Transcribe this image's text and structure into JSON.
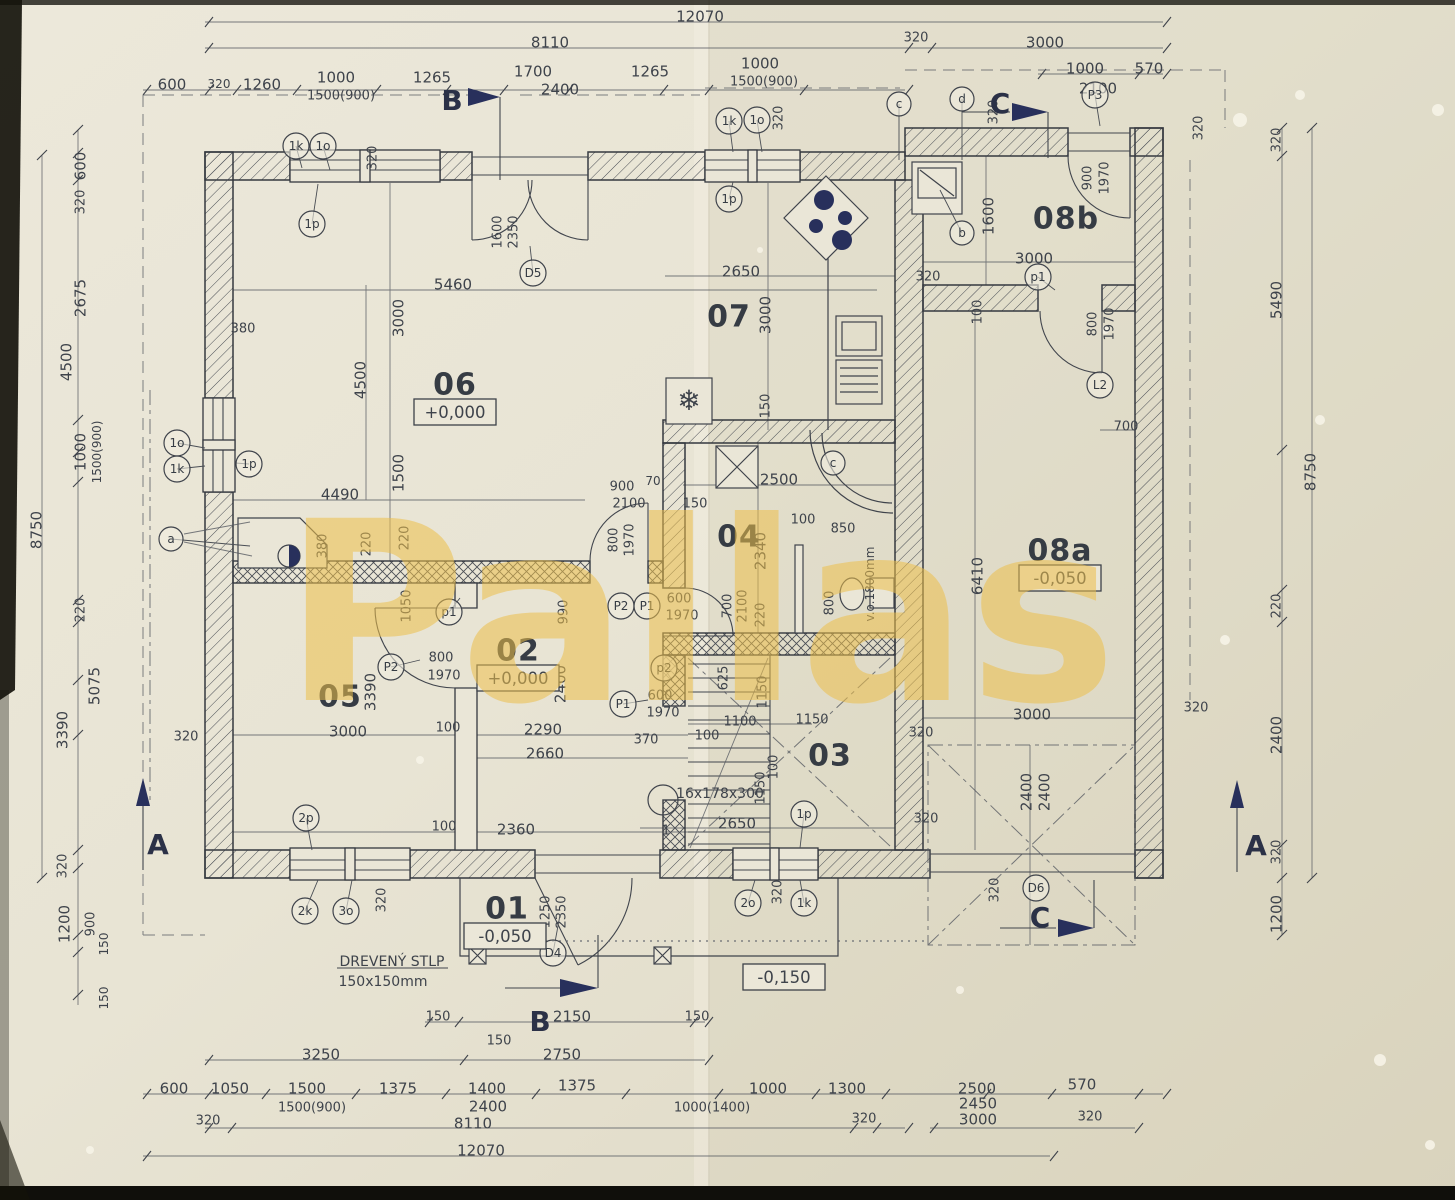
{
  "watermark": {
    "text": "Pallas",
    "color": "#edbf4b"
  },
  "colors": {
    "paper": "#e9e5d6",
    "ink": "#3c4149",
    "navy": "#28305c",
    "watermark": "#edbf4b"
  },
  "rooms": [
    {
      "num": "06",
      "x": 455,
      "y": 384,
      "elev": "+0,000",
      "ex": 455,
      "ey": 412
    },
    {
      "num": "07",
      "x": 729,
      "y": 316
    },
    {
      "num": "08b",
      "x": 1066,
      "y": 218
    },
    {
      "num": "08a",
      "x": 1060,
      "y": 550,
      "elev": "-0,050",
      "ex": 1060,
      "ey": 578
    },
    {
      "num": "04",
      "x": 739,
      "y": 536
    },
    {
      "num": "02",
      "x": 518,
      "y": 650,
      "elev": "+0,000",
      "ex": 518,
      "ey": 678
    },
    {
      "num": "05",
      "x": 340,
      "y": 696
    },
    {
      "num": "03",
      "x": 830,
      "y": 755
    },
    {
      "num": "01",
      "x": 507,
      "y": 908,
      "elev": "-0,050",
      "ex": 505,
      "ey": 936
    }
  ],
  "standalone_elevations": [
    {
      "t": "-0,150",
      "x": 784,
      "y": 977
    }
  ],
  "section_markers": [
    {
      "t": "B",
      "x": 452,
      "y": 100
    },
    {
      "t": "B",
      "x": 540,
      "y": 1021
    },
    {
      "t": "C",
      "x": 1000,
      "y": 103
    },
    {
      "t": "C",
      "x": 1040,
      "y": 917
    },
    {
      "t": "A",
      "x": 158,
      "y": 844
    },
    {
      "t": "A",
      "x": 1256,
      "y": 845
    }
  ],
  "notes": [
    {
      "t": "DREVENÝ STLP",
      "x": 392,
      "y": 961,
      "s": 14
    },
    {
      "t": "150x150mm",
      "x": 383,
      "y": 981,
      "s": 14
    },
    {
      "t": "16x178x300",
      "x": 720,
      "y": 793,
      "s": 14
    },
    {
      "t": "v.o.1800mm",
      "x": 870,
      "y": 584,
      "r": -90,
      "s": 12
    },
    {
      "t": "1",
      "x": 666,
      "y": 830,
      "s": 13
    },
    {
      "t": "❄",
      "x": 689,
      "y": 400,
      "s": 28,
      "c": "navy"
    }
  ],
  "callouts": [
    {
      "t": "1k",
      "x": 296,
      "y": 146,
      "lx": 302,
      "ly": 168
    },
    {
      "t": "1o",
      "x": 323,
      "y": 146,
      "lx": 330,
      "ly": 170
    },
    {
      "t": "1p",
      "x": 312,
      "y": 224,
      "lx": 318,
      "ly": 184
    },
    {
      "t": "1k",
      "x": 729,
      "y": 121,
      "lx": 733,
      "ly": 152
    },
    {
      "t": "1o",
      "x": 757,
      "y": 120,
      "lx": 762,
      "ly": 152
    },
    {
      "t": "1p",
      "x": 729,
      "y": 199,
      "lx": 733,
      "ly": 182
    },
    {
      "t": "c",
      "x": 899,
      "y": 104,
      "lx": 899,
      "ly": 160
    },
    {
      "t": "d",
      "x": 962,
      "y": 99,
      "lx": 962,
      "ly": 160
    },
    {
      "t": "P3",
      "x": 1095,
      "y": 95,
      "lx": 1100,
      "ly": 126
    },
    {
      "t": "b",
      "x": 962,
      "y": 233,
      "lx": 940,
      "ly": 190
    },
    {
      "t": "p1",
      "x": 1038,
      "y": 277,
      "lx": 1055,
      "ly": 290
    },
    {
      "t": "L2",
      "x": 1100,
      "y": 385
    },
    {
      "t": "1o",
      "x": 177,
      "y": 443,
      "lx": 205,
      "ly": 448
    },
    {
      "t": "1k",
      "x": 177,
      "y": 469,
      "lx": 205,
      "ly": 466
    },
    {
      "t": "1p",
      "x": 249,
      "y": 464,
      "lx": 235,
      "ly": 463
    },
    {
      "t": "a",
      "x": 171,
      "y": 539,
      "lx": 250,
      "ly": 546
    },
    {
      "t": "p1",
      "x": 449,
      "y": 612,
      "lx": 460,
      "ly": 598
    },
    {
      "t": "P2",
      "x": 391,
      "y": 667,
      "lx": 420,
      "ly": 660
    },
    {
      "t": "P2",
      "x": 621,
      "y": 606
    },
    {
      "t": "P1",
      "x": 647,
      "y": 606
    },
    {
      "t": "p2",
      "x": 664,
      "y": 668,
      "lx": 672,
      "ly": 680
    },
    {
      "t": "P1",
      "x": 623,
      "y": 704,
      "lx": 648,
      "ly": 700
    },
    {
      "t": "c",
      "x": 833,
      "y": 463
    },
    {
      "t": "2p",
      "x": 306,
      "y": 818,
      "lx": 312,
      "ly": 850
    },
    {
      "t": "2k",
      "x": 305,
      "y": 911,
      "lx": 318,
      "ly": 880
    },
    {
      "t": "3o",
      "x": 346,
      "y": 911,
      "lx": 352,
      "ly": 880
    },
    {
      "t": "2o",
      "x": 748,
      "y": 903,
      "lx": 755,
      "ly": 880
    },
    {
      "t": "1k",
      "x": 804,
      "y": 903,
      "lx": 800,
      "ly": 880
    },
    {
      "t": "1p",
      "x": 804,
      "y": 814,
      "lx": 800,
      "ly": 848
    },
    {
      "t": "D4",
      "x": 553,
      "y": 953,
      "lx": 560,
      "ly": 915
    },
    {
      "t": "D5",
      "x": 533,
      "y": 273,
      "lx": 530,
      "ly": 246
    },
    {
      "t": "D6",
      "x": 1036,
      "y": 888
    }
  ],
  "dims": [
    {
      "t": "12070",
      "x": 700,
      "y": 16
    },
    {
      "t": "8110",
      "x": 550,
      "y": 42
    },
    {
      "t": "320",
      "x": 916,
      "y": 37,
      "s": 13
    },
    {
      "t": "3000",
      "x": 1045,
      "y": 42
    },
    {
      "t": "1000",
      "x": 1085,
      "y": 68
    },
    {
      "t": "570",
      "x": 1149,
      "y": 68
    },
    {
      "t": "2100",
      "x": 1098,
      "y": 88
    },
    {
      "t": "600",
      "x": 172,
      "y": 84
    },
    {
      "t": "320",
      "x": 219,
      "y": 84,
      "s": 12
    },
    {
      "t": "1260",
      "x": 262,
      "y": 84
    },
    {
      "t": "1000",
      "x": 336,
      "y": 77
    },
    {
      "t": "1500(900)",
      "x": 341,
      "y": 95,
      "s": 13
    },
    {
      "t": "1265",
      "x": 432,
      "y": 77
    },
    {
      "t": "1700",
      "x": 533,
      "y": 71
    },
    {
      "t": "2400",
      "x": 560,
      "y": 89
    },
    {
      "t": "1265",
      "x": 650,
      "y": 71
    },
    {
      "t": "1000",
      "x": 760,
      "y": 63
    },
    {
      "t": "1500(900)",
      "x": 764,
      "y": 81,
      "s": 13
    },
    {
      "t": "320",
      "x": 372,
      "y": 158,
      "r": -90,
      "s": 13
    },
    {
      "t": "320",
      "x": 778,
      "y": 118,
      "r": -90,
      "s": 13
    },
    {
      "t": "320",
      "x": 993,
      "y": 112,
      "r": -90,
      "s": 13
    },
    {
      "t": "320",
      "x": 1198,
      "y": 128,
      "r": -90,
      "s": 13
    },
    {
      "t": "600",
      "x": 80,
      "y": 166,
      "r": -90
    },
    {
      "t": "320",
      "x": 80,
      "y": 202,
      "r": -90,
      "s": 13
    },
    {
      "t": "2675",
      "x": 80,
      "y": 298,
      "r": -90
    },
    {
      "t": "4500",
      "x": 66,
      "y": 362,
      "r": -90
    },
    {
      "t": "1000",
      "x": 80,
      "y": 452,
      "r": -90
    },
    {
      "t": "1500(900)",
      "x": 97,
      "y": 452,
      "r": -90,
      "s": 12
    },
    {
      "t": "220",
      "x": 80,
      "y": 610,
      "r": -90,
      "s": 13
    },
    {
      "t": "8750",
      "x": 36,
      "y": 530,
      "r": -90
    },
    {
      "t": "5075",
      "x": 94,
      "y": 686,
      "r": -90
    },
    {
      "t": "3390",
      "x": 62,
      "y": 730,
      "r": -90
    },
    {
      "t": "320",
      "x": 62,
      "y": 866,
      "r": -90,
      "s": 13
    },
    {
      "t": "1200",
      "x": 64,
      "y": 924,
      "r": -90
    },
    {
      "t": "900",
      "x": 90,
      "y": 924,
      "r": -90,
      "s": 13
    },
    {
      "t": "150",
      "x": 104,
      "y": 944,
      "r": -90,
      "s": 12
    },
    {
      "t": "150",
      "x": 104,
      "y": 998,
      "r": -90,
      "s": 12
    },
    {
      "t": "380",
      "x": 243,
      "y": 328,
      "s": 13
    },
    {
      "t": "5460",
      "x": 453,
      "y": 284
    },
    {
      "t": "3000",
      "x": 398,
      "y": 318,
      "r": -90
    },
    {
      "t": "4500",
      "x": 360,
      "y": 380,
      "r": -90
    },
    {
      "t": "1500",
      "x": 398,
      "y": 473,
      "r": -90
    },
    {
      "t": "4490",
      "x": 340,
      "y": 494
    },
    {
      "t": "380",
      "x": 322,
      "y": 546,
      "r": -90,
      "s": 13
    },
    {
      "t": "220",
      "x": 366,
      "y": 544,
      "r": -90,
      "s": 13
    },
    {
      "t": "220",
      "x": 404,
      "y": 538,
      "r": -90,
      "s": 13
    },
    {
      "t": "1600",
      "x": 497,
      "y": 232,
      "r": -90,
      "s": 13
    },
    {
      "t": "2350",
      "x": 513,
      "y": 232,
      "r": -90,
      "s": 13
    },
    {
      "t": "900",
      "x": 622,
      "y": 486,
      "s": 13
    },
    {
      "t": "2100",
      "x": 629,
      "y": 503,
      "s": 13
    },
    {
      "t": "70",
      "x": 653,
      "y": 481,
      "s": 12
    },
    {
      "t": "800",
      "x": 613,
      "y": 540,
      "r": -90,
      "s": 13
    },
    {
      "t": "1970",
      "x": 629,
      "y": 540,
      "r": -90,
      "s": 13
    },
    {
      "t": "1050",
      "x": 406,
      "y": 606,
      "r": -90,
      "s": 13
    },
    {
      "t": "990",
      "x": 563,
      "y": 612,
      "r": -90,
      "s": 13
    },
    {
      "t": "2400",
      "x": 560,
      "y": 684,
      "r": -90
    },
    {
      "t": "800",
      "x": 441,
      "y": 657,
      "s": 13
    },
    {
      "t": "1970",
      "x": 444,
      "y": 675,
      "s": 13
    },
    {
      "t": "3390",
      "x": 370,
      "y": 692,
      "r": -90
    },
    {
      "t": "3000",
      "x": 348,
      "y": 731
    },
    {
      "t": "100",
      "x": 448,
      "y": 727,
      "s": 13
    },
    {
      "t": "2290",
      "x": 543,
      "y": 729
    },
    {
      "t": "2660",
      "x": 545,
      "y": 753
    },
    {
      "t": "320",
      "x": 186,
      "y": 736,
      "s": 13
    },
    {
      "t": "100",
      "x": 444,
      "y": 826,
      "s": 13
    },
    {
      "t": "2360",
      "x": 516,
      "y": 829
    },
    {
      "t": "370",
      "x": 646,
      "y": 739,
      "s": 13
    },
    {
      "t": "600",
      "x": 679,
      "y": 598,
      "s": 13
    },
    {
      "t": "1970",
      "x": 682,
      "y": 615,
      "s": 13
    },
    {
      "t": "700",
      "x": 727,
      "y": 606,
      "r": -90,
      "s": 13
    },
    {
      "t": "2100",
      "x": 742,
      "y": 606,
      "r": -90,
      "s": 13
    },
    {
      "t": "220",
      "x": 760,
      "y": 615,
      "r": -90,
      "s": 13
    },
    {
      "t": "2340",
      "x": 760,
      "y": 551,
      "r": -90
    },
    {
      "t": "2500",
      "x": 779,
      "y": 479
    },
    {
      "t": "150",
      "x": 695,
      "y": 503,
      "s": 13
    },
    {
      "t": "100",
      "x": 803,
      "y": 519,
      "s": 13
    },
    {
      "t": "850",
      "x": 843,
      "y": 528,
      "s": 13
    },
    {
      "t": "800",
      "x": 829,
      "y": 603,
      "r": -90,
      "s": 13
    },
    {
      "t": "600",
      "x": 660,
      "y": 695,
      "s": 13
    },
    {
      "t": "1970",
      "x": 663,
      "y": 712,
      "s": 13
    },
    {
      "t": "625",
      "x": 723,
      "y": 678,
      "r": -90,
      "s": 13
    },
    {
      "t": "1150",
      "x": 762,
      "y": 692,
      "r": -90,
      "s": 13
    },
    {
      "t": "1100",
      "x": 740,
      "y": 721,
      "s": 13
    },
    {
      "t": "100",
      "x": 707,
      "y": 735,
      "s": 13
    },
    {
      "t": "1150",
      "x": 812,
      "y": 719,
      "s": 13
    },
    {
      "t": "100",
      "x": 773,
      "y": 767,
      "r": -90,
      "s": 13
    },
    {
      "t": "1150",
      "x": 760,
      "y": 788,
      "r": -90,
      "s": 13
    },
    {
      "t": "2650",
      "x": 737,
      "y": 823
    },
    {
      "t": "2650",
      "x": 741,
      "y": 271
    },
    {
      "t": "3000",
      "x": 765,
      "y": 315,
      "r": -90
    },
    {
      "t": "150",
      "x": 765,
      "y": 406,
      "r": -90,
      "s": 13
    },
    {
      "t": "1600",
      "x": 988,
      "y": 216,
      "r": -90
    },
    {
      "t": "3000",
      "x": 1034,
      "y": 258
    },
    {
      "t": "320",
      "x": 928,
      "y": 276,
      "s": 13
    },
    {
      "t": "100",
      "x": 977,
      "y": 312,
      "r": -90,
      "s": 13
    },
    {
      "t": "900",
      "x": 1087,
      "y": 178,
      "r": -90,
      "s": 13
    },
    {
      "t": "1970",
      "x": 1104,
      "y": 178,
      "r": -90,
      "s": 13
    },
    {
      "t": "800",
      "x": 1092,
      "y": 324,
      "r": -90,
      "s": 13
    },
    {
      "t": "1970",
      "x": 1109,
      "y": 324,
      "r": -90,
      "s": 13
    },
    {
      "t": "700",
      "x": 1126,
      "y": 426,
      "s": 13
    },
    {
      "t": "6410",
      "x": 977,
      "y": 576,
      "r": -90
    },
    {
      "t": "3000",
      "x": 1032,
      "y": 714
    },
    {
      "t": "320",
      "x": 1196,
      "y": 707,
      "s": 13
    },
    {
      "t": "320",
      "x": 921,
      "y": 732,
      "s": 13
    },
    {
      "t": "320",
      "x": 926,
      "y": 818,
      "s": 13
    },
    {
      "t": "2400",
      "x": 1026,
      "y": 792,
      "r": -90
    },
    {
      "t": "2400",
      "x": 1044,
      "y": 792,
      "r": -90
    },
    {
      "t": "320",
      "x": 994,
      "y": 890,
      "r": -90,
      "s": 13
    },
    {
      "t": "320",
      "x": 1276,
      "y": 140,
      "r": -90,
      "s": 13
    },
    {
      "t": "5490",
      "x": 1276,
      "y": 300,
      "r": -90
    },
    {
      "t": "8750",
      "x": 1310,
      "y": 472,
      "r": -90
    },
    {
      "t": "220",
      "x": 1276,
      "y": 606,
      "r": -90,
      "s": 13
    },
    {
      "t": "2400",
      "x": 1276,
      "y": 735,
      "r": -90
    },
    {
      "t": "320",
      "x": 1276,
      "y": 852,
      "r": -90,
      "s": 13
    },
    {
      "t": "1200",
      "x": 1276,
      "y": 914,
      "r": -90
    },
    {
      "t": "320",
      "x": 381,
      "y": 900,
      "r": -90,
      "s": 13
    },
    {
      "t": "320",
      "x": 777,
      "y": 892,
      "r": -90,
      "s": 13
    },
    {
      "t": "1250",
      "x": 545,
      "y": 912,
      "r": -90,
      "s": 13
    },
    {
      "t": "2350",
      "x": 561,
      "y": 912,
      "r": -90,
      "s": 13
    },
    {
      "t": "150",
      "x": 438,
      "y": 1016,
      "s": 13
    },
    {
      "t": "2150",
      "x": 572,
      "y": 1016
    },
    {
      "t": "150",
      "x": 697,
      "y": 1016,
      "s": 13
    },
    {
      "t": "150",
      "x": 499,
      "y": 1040,
      "s": 13
    },
    {
      "t": "3250",
      "x": 321,
      "y": 1054
    },
    {
      "t": "2750",
      "x": 562,
      "y": 1054
    },
    {
      "t": "600",
      "x": 174,
      "y": 1088
    },
    {
      "t": "1050",
      "x": 230,
      "y": 1088
    },
    {
      "t": "1500",
      "x": 307,
      "y": 1088
    },
    {
      "t": "1375",
      "x": 398,
      "y": 1088
    },
    {
      "t": "1400",
      "x": 487,
      "y": 1088
    },
    {
      "t": "1375",
      "x": 577,
      "y": 1085
    },
    {
      "t": "1000",
      "x": 768,
      "y": 1088
    },
    {
      "t": "1300",
      "x": 847,
      "y": 1088
    },
    {
      "t": "2500",
      "x": 977,
      "y": 1088
    },
    {
      "t": "570",
      "x": 1082,
      "y": 1084
    },
    {
      "t": "1500(900)",
      "x": 312,
      "y": 1107,
      "s": 13
    },
    {
      "t": "2400",
      "x": 488,
      "y": 1106
    },
    {
      "t": "1000(1400)",
      "x": 712,
      "y": 1107,
      "s": 13
    },
    {
      "t": "2450",
      "x": 978,
      "y": 1103
    },
    {
      "t": "320",
      "x": 208,
      "y": 1120,
      "s": 13
    },
    {
      "t": "8110",
      "x": 473,
      "y": 1123
    },
    {
      "t": "320",
      "x": 864,
      "y": 1118,
      "s": 13
    },
    {
      "t": "3000",
      "x": 978,
      "y": 1119
    },
    {
      "t": "320",
      "x": 1090,
      "y": 1116,
      "s": 13
    },
    {
      "t": "12070",
      "x": 481,
      "y": 1150
    }
  ]
}
